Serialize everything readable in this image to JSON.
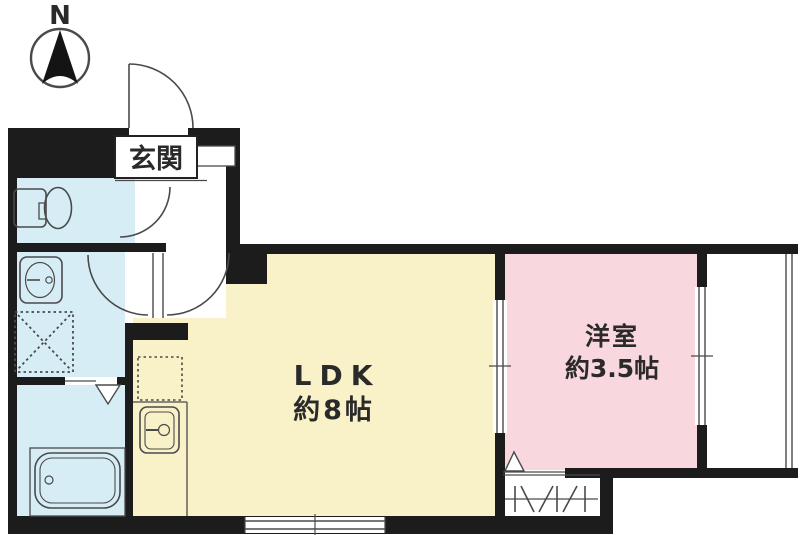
{
  "title": "間取り図",
  "compass": {
    "label": "N"
  },
  "rooms": {
    "entrance": {
      "label": "玄関"
    },
    "ldk": {
      "label": "LDK",
      "size": "約8帖"
    },
    "western": {
      "label": "洋室",
      "size": "約3.5帖"
    }
  },
  "fixtures": {
    "toilet": "toilet",
    "washbasin": "washbasin",
    "washing_machine_space": "washing-machine-space",
    "bathtub": "bathtub",
    "kitchen_sink": "kitchen-sink",
    "refrigerator_space": "refrigerator-space",
    "closet": "closet",
    "balcony": "balcony"
  },
  "colors": {
    "wall": "#1c1c1c",
    "water": "#d7edf6",
    "ldk": "#f9f2c9",
    "western": "#f8d7df",
    "line": "#4a4a4a",
    "text": "#2a2a2a",
    "white": "#ffffff"
  }
}
